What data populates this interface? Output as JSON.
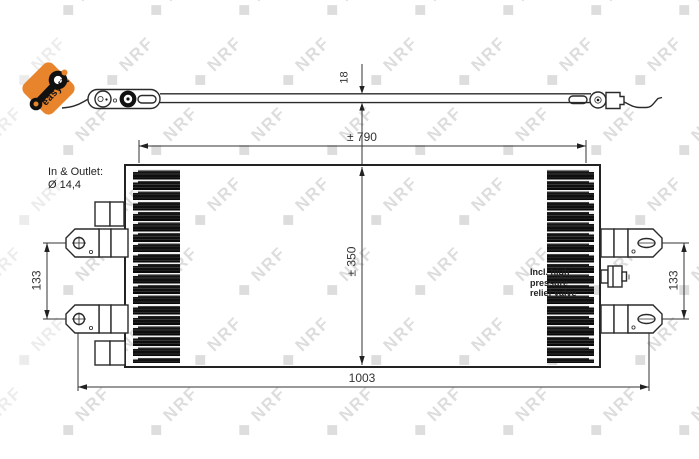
{
  "watermark": {
    "text": "NRF",
    "diamond": "◆"
  },
  "badge": {
    "label": "easyfit",
    "color": "#e8852c"
  },
  "notes": {
    "inlet_outlet_line1": "In & Outlet:",
    "inlet_outlet_line2": "Ø 14,4",
    "valve_line1": "Incl. high pressure",
    "valve_line2": "relief valve"
  },
  "dimensions": {
    "strip_height": "18",
    "core_width": "± 790",
    "core_height": "± 350",
    "overall_width": "1003",
    "pin_spacing_left": "133",
    "pin_spacing_right": "133"
  },
  "colors": {
    "accent_orange": "#e8852c",
    "line": "#2a2a2a",
    "watermark_gray": "#b5b5b5",
    "fin_dark": "#0f0f0f"
  }
}
